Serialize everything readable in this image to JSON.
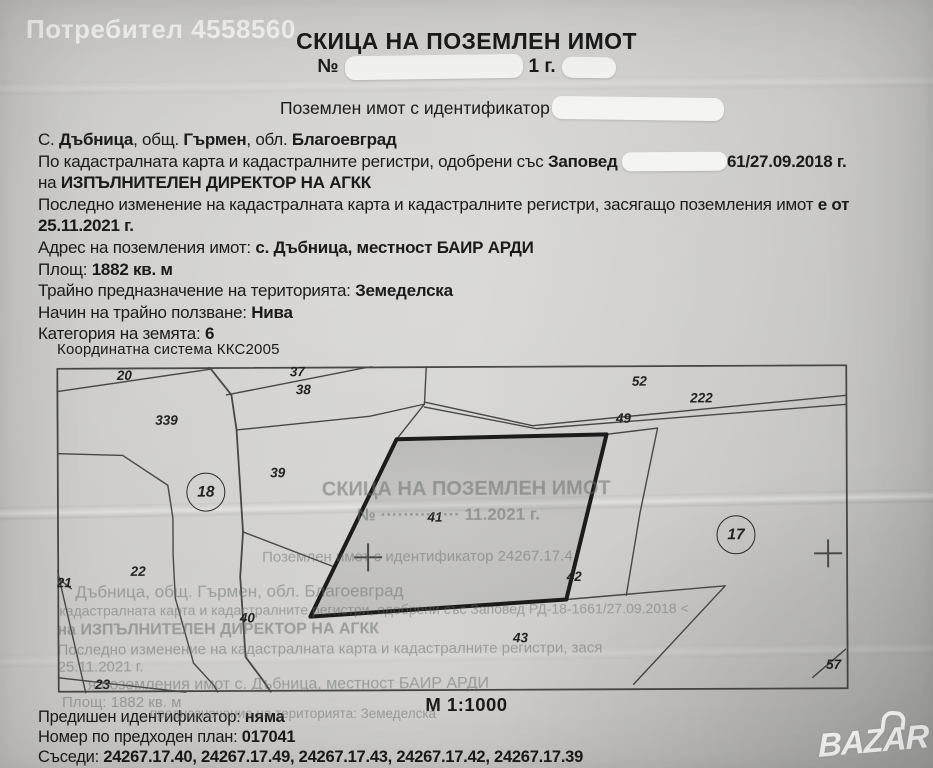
{
  "watermark": {
    "user": "Потребител 4558560",
    "brand": "BAZAR"
  },
  "title": {
    "line1": "СКИЦА НА ПОЗЕМЛЕН ИМОТ",
    "number_prefix": "№",
    "number_visible_suffix": "1 г.",
    "identifier_label": "Поземлен имот с идентификатор"
  },
  "info_lines": [
    {
      "segments": [
        [
          "С. ",
          0
        ],
        [
          "Дъбница",
          1
        ],
        [
          ", общ. ",
          0
        ],
        [
          "Гърмен",
          1
        ],
        [
          ", обл. ",
          0
        ],
        [
          "Благоевград",
          1
        ]
      ]
    },
    {
      "segments": [
        [
          "По кадастралната карта и кадастралните регистри, одобрени със ",
          0
        ],
        [
          "Заповед ",
          1
        ],
        [
          "",
          2
        ],
        [
          "61/27.09.2018 г.",
          1
        ]
      ]
    },
    {
      "segments": [
        [
          "на ",
          0
        ],
        [
          "ИЗПЪЛНИТЕЛЕН ДИРЕКТОР НА АГКК",
          1
        ]
      ]
    },
    {
      "segments": [
        [
          "Последно изменение на кадастралната карта и кадастралните регистри, засягащо поземления имот ",
          0
        ],
        [
          "е от",
          1
        ]
      ]
    },
    {
      "segments": [
        [
          "25.11.2021 г.",
          1
        ]
      ]
    },
    {
      "segments": [
        [
          "Адрес на поземления имот: ",
          0
        ],
        [
          "с. Дъбница, местност БАИР АРДИ",
          1
        ]
      ]
    },
    {
      "segments": [
        [
          "Площ: ",
          0
        ],
        [
          "1882 кв. м",
          1
        ]
      ]
    },
    {
      "segments": [
        [
          "Трайно предназначение на територията: ",
          0
        ],
        [
          "Земеделска",
          1
        ]
      ]
    },
    {
      "segments": [
        [
          "Начин на трайно ползване: ",
          0
        ],
        [
          "Нива",
          1
        ]
      ]
    },
    {
      "segments": [
        [
          "Категория на земята: ",
          0
        ],
        [
          "6",
          1
        ]
      ]
    }
  ],
  "map": {
    "coord_system": "Координатна система ККС2005",
    "scale": "М 1:1000",
    "parcel_labels": [
      {
        "id": "20",
        "x": 68,
        "y": 8
      },
      {
        "id": "339",
        "x": 110,
        "y": 53
      },
      {
        "id": "37",
        "x": 241,
        "y": 5
      },
      {
        "id": "38",
        "x": 247,
        "y": 23
      },
      {
        "id": "39",
        "x": 221,
        "y": 106
      },
      {
        "id": "52",
        "x": 583,
        "y": 16
      },
      {
        "id": "222",
        "x": 645,
        "y": 33
      },
      {
        "id": "49",
        "x": 567,
        "y": 53
      },
      {
        "id": "41",
        "x": 378,
        "y": 151
      },
      {
        "id": "22",
        "x": 81,
        "y": 204
      },
      {
        "id": "21",
        "x": 7,
        "y": 215
      },
      {
        "id": "40",
        "x": 190,
        "y": 251
      },
      {
        "id": "23",
        "x": 45,
        "y": 317
      },
      {
        "id": "42",
        "x": 517,
        "y": 211
      },
      {
        "id": "43",
        "x": 463,
        "y": 272
      },
      {
        "id": "57",
        "x": 776,
        "y": 300
      }
    ],
    "circled_labels": [
      {
        "id": "18",
        "x": 149,
        "y": 125
      },
      {
        "id": "17",
        "x": 679,
        "y": 170
      }
    ],
    "cross_marks": [
      {
        "x": 311,
        "y": 191
      },
      {
        "x": 771,
        "y": 189
      }
    ],
    "ghost_lines": [
      {
        "text": "СКИЦА НА ПОЗЕМЛЕН ИМОТ",
        "x": 265,
        "y": 112,
        "size": 20,
        "bold": 1
      },
      {
        "text": "№ ·············· 11.2021 г.",
        "x": 300,
        "y": 139,
        "size": 17,
        "bold": 1
      },
      {
        "text": "Поземлен имот с  идентификатор  24267.17.4",
        "x": 205,
        "y": 182,
        "size": 15,
        "bold": 0
      },
      {
        "text": "Дъбница, общ. Гърмен, обл. Благоевград",
        "x": 18,
        "y": 215,
        "size": 17,
        "bold": 0
      },
      {
        "text": "кадастралната карта и кадастралните регистри, одобрени със Заповед РД-18-1661/27.09.2018 <",
        "x": 2,
        "y": 235,
        "size": 14,
        "bold": 0
      },
      {
        "text": "на ИЗПЪЛНИТЕЛЕН ДИРЕКТОР НА АГКК",
        "x": 0,
        "y": 254,
        "size": 16,
        "bold": 1
      },
      {
        "text": "Последно изменение на кадастралната карта и кадастралните регистри, зася",
        "x": 0,
        "y": 274,
        "size": 15,
        "bold": 0
      },
      {
        "text": "25.11.2021 г.",
        "x": 0,
        "y": 291,
        "size": 15,
        "bold": 0
      },
      {
        "text": "я поземления имот  с. Дъбница, местност БАИР АРДИ",
        "x": 30,
        "y": 309,
        "size": 16,
        "bold": 0
      }
    ],
    "ghost_below": [
      {
        "text": "Площ: 1882 кв. м",
        "x": 62,
        "y": 694,
        "size": 15,
        "bold": 0
      },
      {
        "text": "предназначение на територията: Земеделска",
        "x": 150,
        "y": 706,
        "size": 13.5,
        "bold": 0
      }
    ]
  },
  "footer_lines": [
    {
      "segments": [
        [
          "Предишен идентификатор: ",
          0
        ],
        [
          "няма",
          1
        ]
      ]
    },
    {
      "segments": [
        [
          "Номер по предходен план: ",
          0
        ],
        [
          "017041",
          1
        ]
      ]
    },
    {
      "segments": [
        [
          "Съседи: ",
          0
        ],
        [
          "24267.17.40, 24267.17.49, 24267.17.43, 24267.17.42, 24267.17.39",
          1
        ]
      ]
    }
  ]
}
